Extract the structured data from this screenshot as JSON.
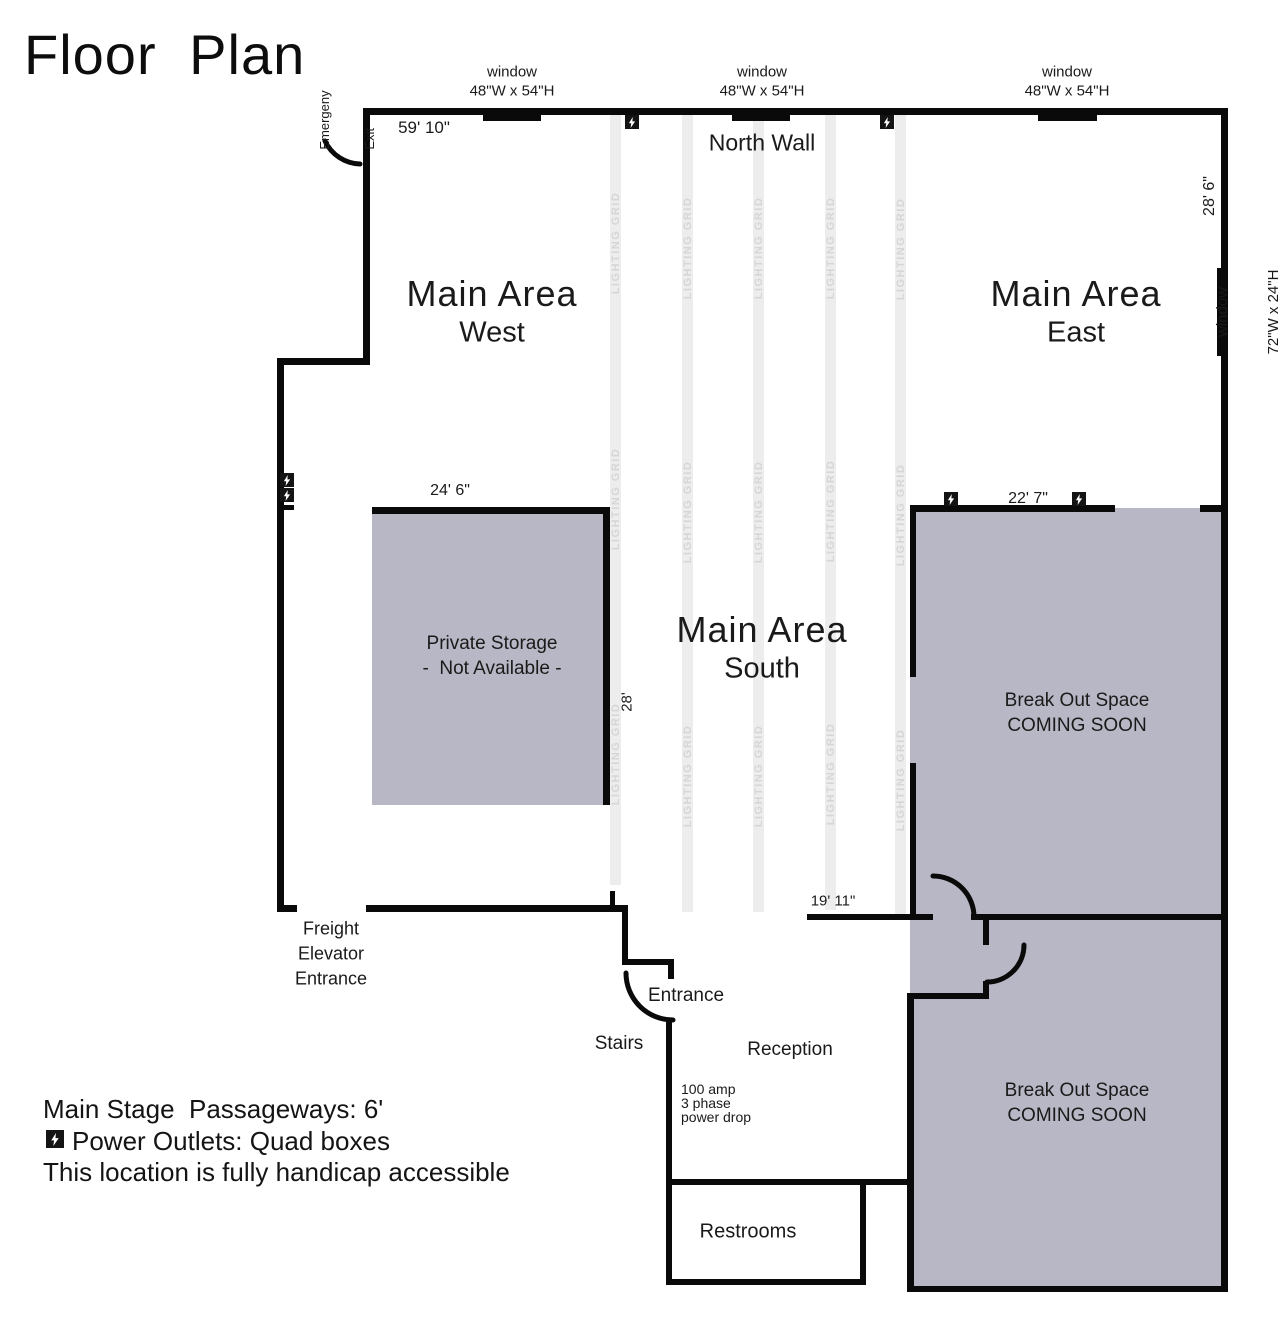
{
  "title": "Floor Plan",
  "plan": {
    "north_wall": "North Wall",
    "lighting_grid": "LIGHTING GRID",
    "rooms": {
      "west": {
        "line1": "Main Area",
        "line2": "West"
      },
      "east": {
        "line1": "Main Area",
        "line2": "East"
      },
      "south": {
        "line1": "Main Area",
        "line2": "South"
      },
      "storage": {
        "line1": "Private Storage",
        "line2": "-  Not Available -"
      },
      "breakout1": {
        "line1": "Break Out Space",
        "line2": "COMING SOON"
      },
      "breakout2": {
        "line1": "Break Out Space",
        "line2": "COMING SOON"
      },
      "restrooms": "Restrooms"
    },
    "windows": {
      "top": {
        "line1": "window",
        "line2": "48\"W x 54\"H"
      },
      "right": {
        "line1": "window",
        "line2": "72\"W x 24\"H"
      }
    },
    "dimensions": {
      "west_width": "59' 10\"",
      "east_height": "28' 6\"",
      "storage_width": "24' 6\"",
      "storage_height": "28'",
      "breakout_width": "22' 7\"",
      "passage": "19' 11\""
    },
    "annotations": {
      "emergency_exit": {
        "line1": "Emergeny",
        "line2": "Exit"
      },
      "freight": {
        "line1": "Freight",
        "line2": "Elevator",
        "line3": "Entrance"
      },
      "entrance": "Entrance",
      "stairs": "Stairs",
      "reception": "Reception",
      "power_drop": {
        "line1": "100 amp",
        "line2": "3 phase",
        "line3": "power drop"
      }
    }
  },
  "legend": {
    "line1": "Main Stage  Passageways: 6'",
    "line2": "Power Outlets: Quad boxes",
    "line3": "This location is fully handicap accessible"
  },
  "colors": {
    "area_fill": "#b8b7c5",
    "wall": "#0a0a0a",
    "strip": "#ededed",
    "strip_text": "#d6d6d6"
  }
}
